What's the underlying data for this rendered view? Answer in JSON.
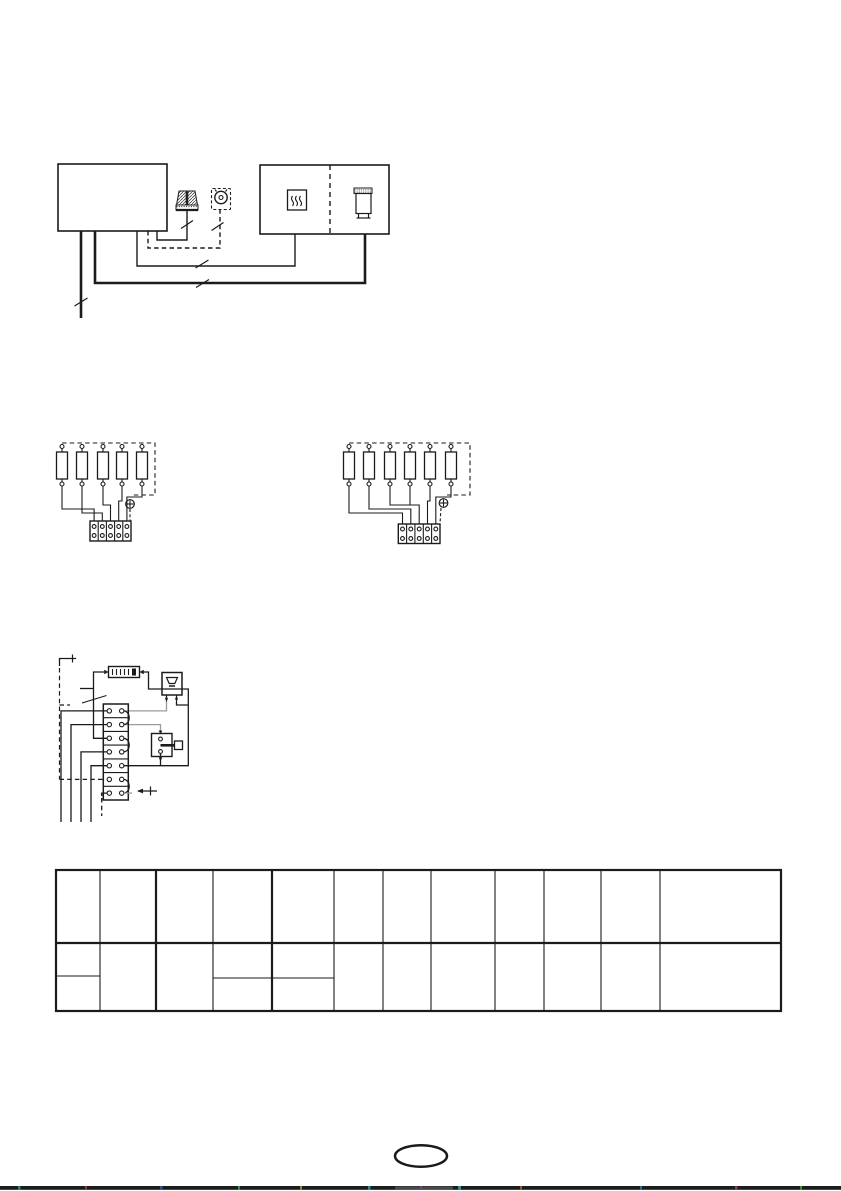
{
  "page": {
    "width": 841,
    "height": 1191,
    "background": "#ffffff",
    "ink": "#1b1b1b",
    "gray_wire": "#9b9b9b"
  },
  "top_diagram": {
    "left_boxes": 1,
    "right_box_sections": 2,
    "component_icons": [
      "plug-icon",
      "dial-thermostat-icon",
      "heater-icon",
      "cylinder-icon"
    ],
    "cable_slash_marks": 5
  },
  "link_diagrams": {
    "left_link_count": 5,
    "right_link_count": 6,
    "terminal_ways": 5,
    "earth_screw_symbols": 2
  },
  "terminal_strip_diagram": {
    "terminal_rows": 7,
    "bridge_links": 3,
    "components": [
      "fuse-strip",
      "bell-component",
      "switch-component"
    ]
  },
  "table": {
    "column_count": 12,
    "header_row_count": 1,
    "body_row_count": 1,
    "split_columns": [
      1,
      4,
      5
    ],
    "cells_empty": true
  },
  "footer": {
    "page_number": "",
    "scan_strip_color": "#1c1c1c"
  }
}
